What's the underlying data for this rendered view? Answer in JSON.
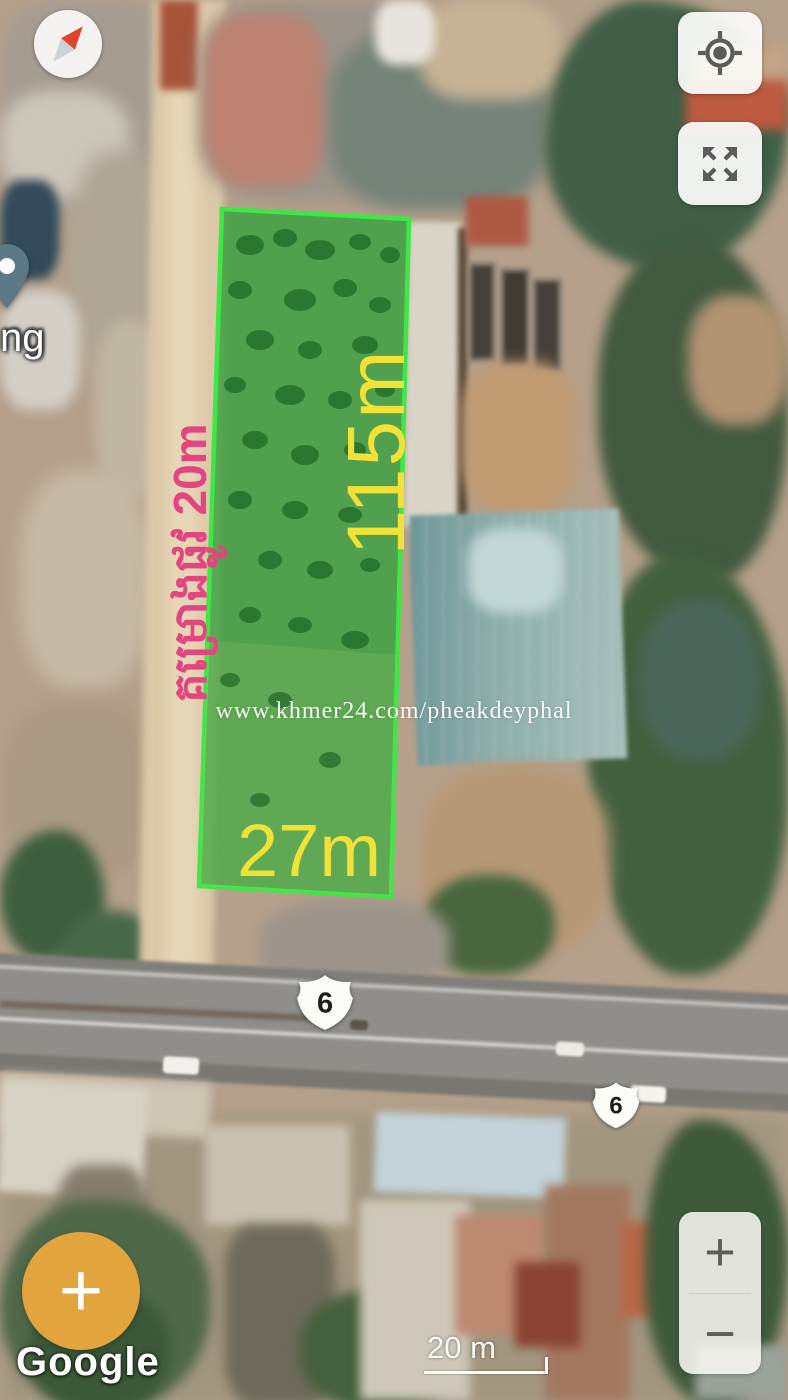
{
  "controls": {
    "compass_icon": "compass-needle",
    "my_location_icon": "crosshair-target",
    "fullscreen_icon": "expand-arrows",
    "zoom_in_label": "+",
    "zoom_out_label": "−",
    "add_button_label": "+"
  },
  "map_labels": {
    "shields": [
      "6",
      "6"
    ],
    "partial_place": "ng"
  },
  "annotations": {
    "depth": "115m",
    "frontage": "27m",
    "road": "គម្រោងផ្លូវ 20m",
    "watermark": "www.khmer24.com/pheakdeyphal"
  },
  "attribution": {
    "logo": "Google"
  },
  "scale": {
    "label": "20 m"
  },
  "colors": {
    "plot_border": "#3BE844",
    "plot_fill": "rgba(52,160,60,0.78)",
    "measurement_text": "#F2E136",
    "road_text": "#E4457E",
    "fab": "#E2A43C"
  }
}
